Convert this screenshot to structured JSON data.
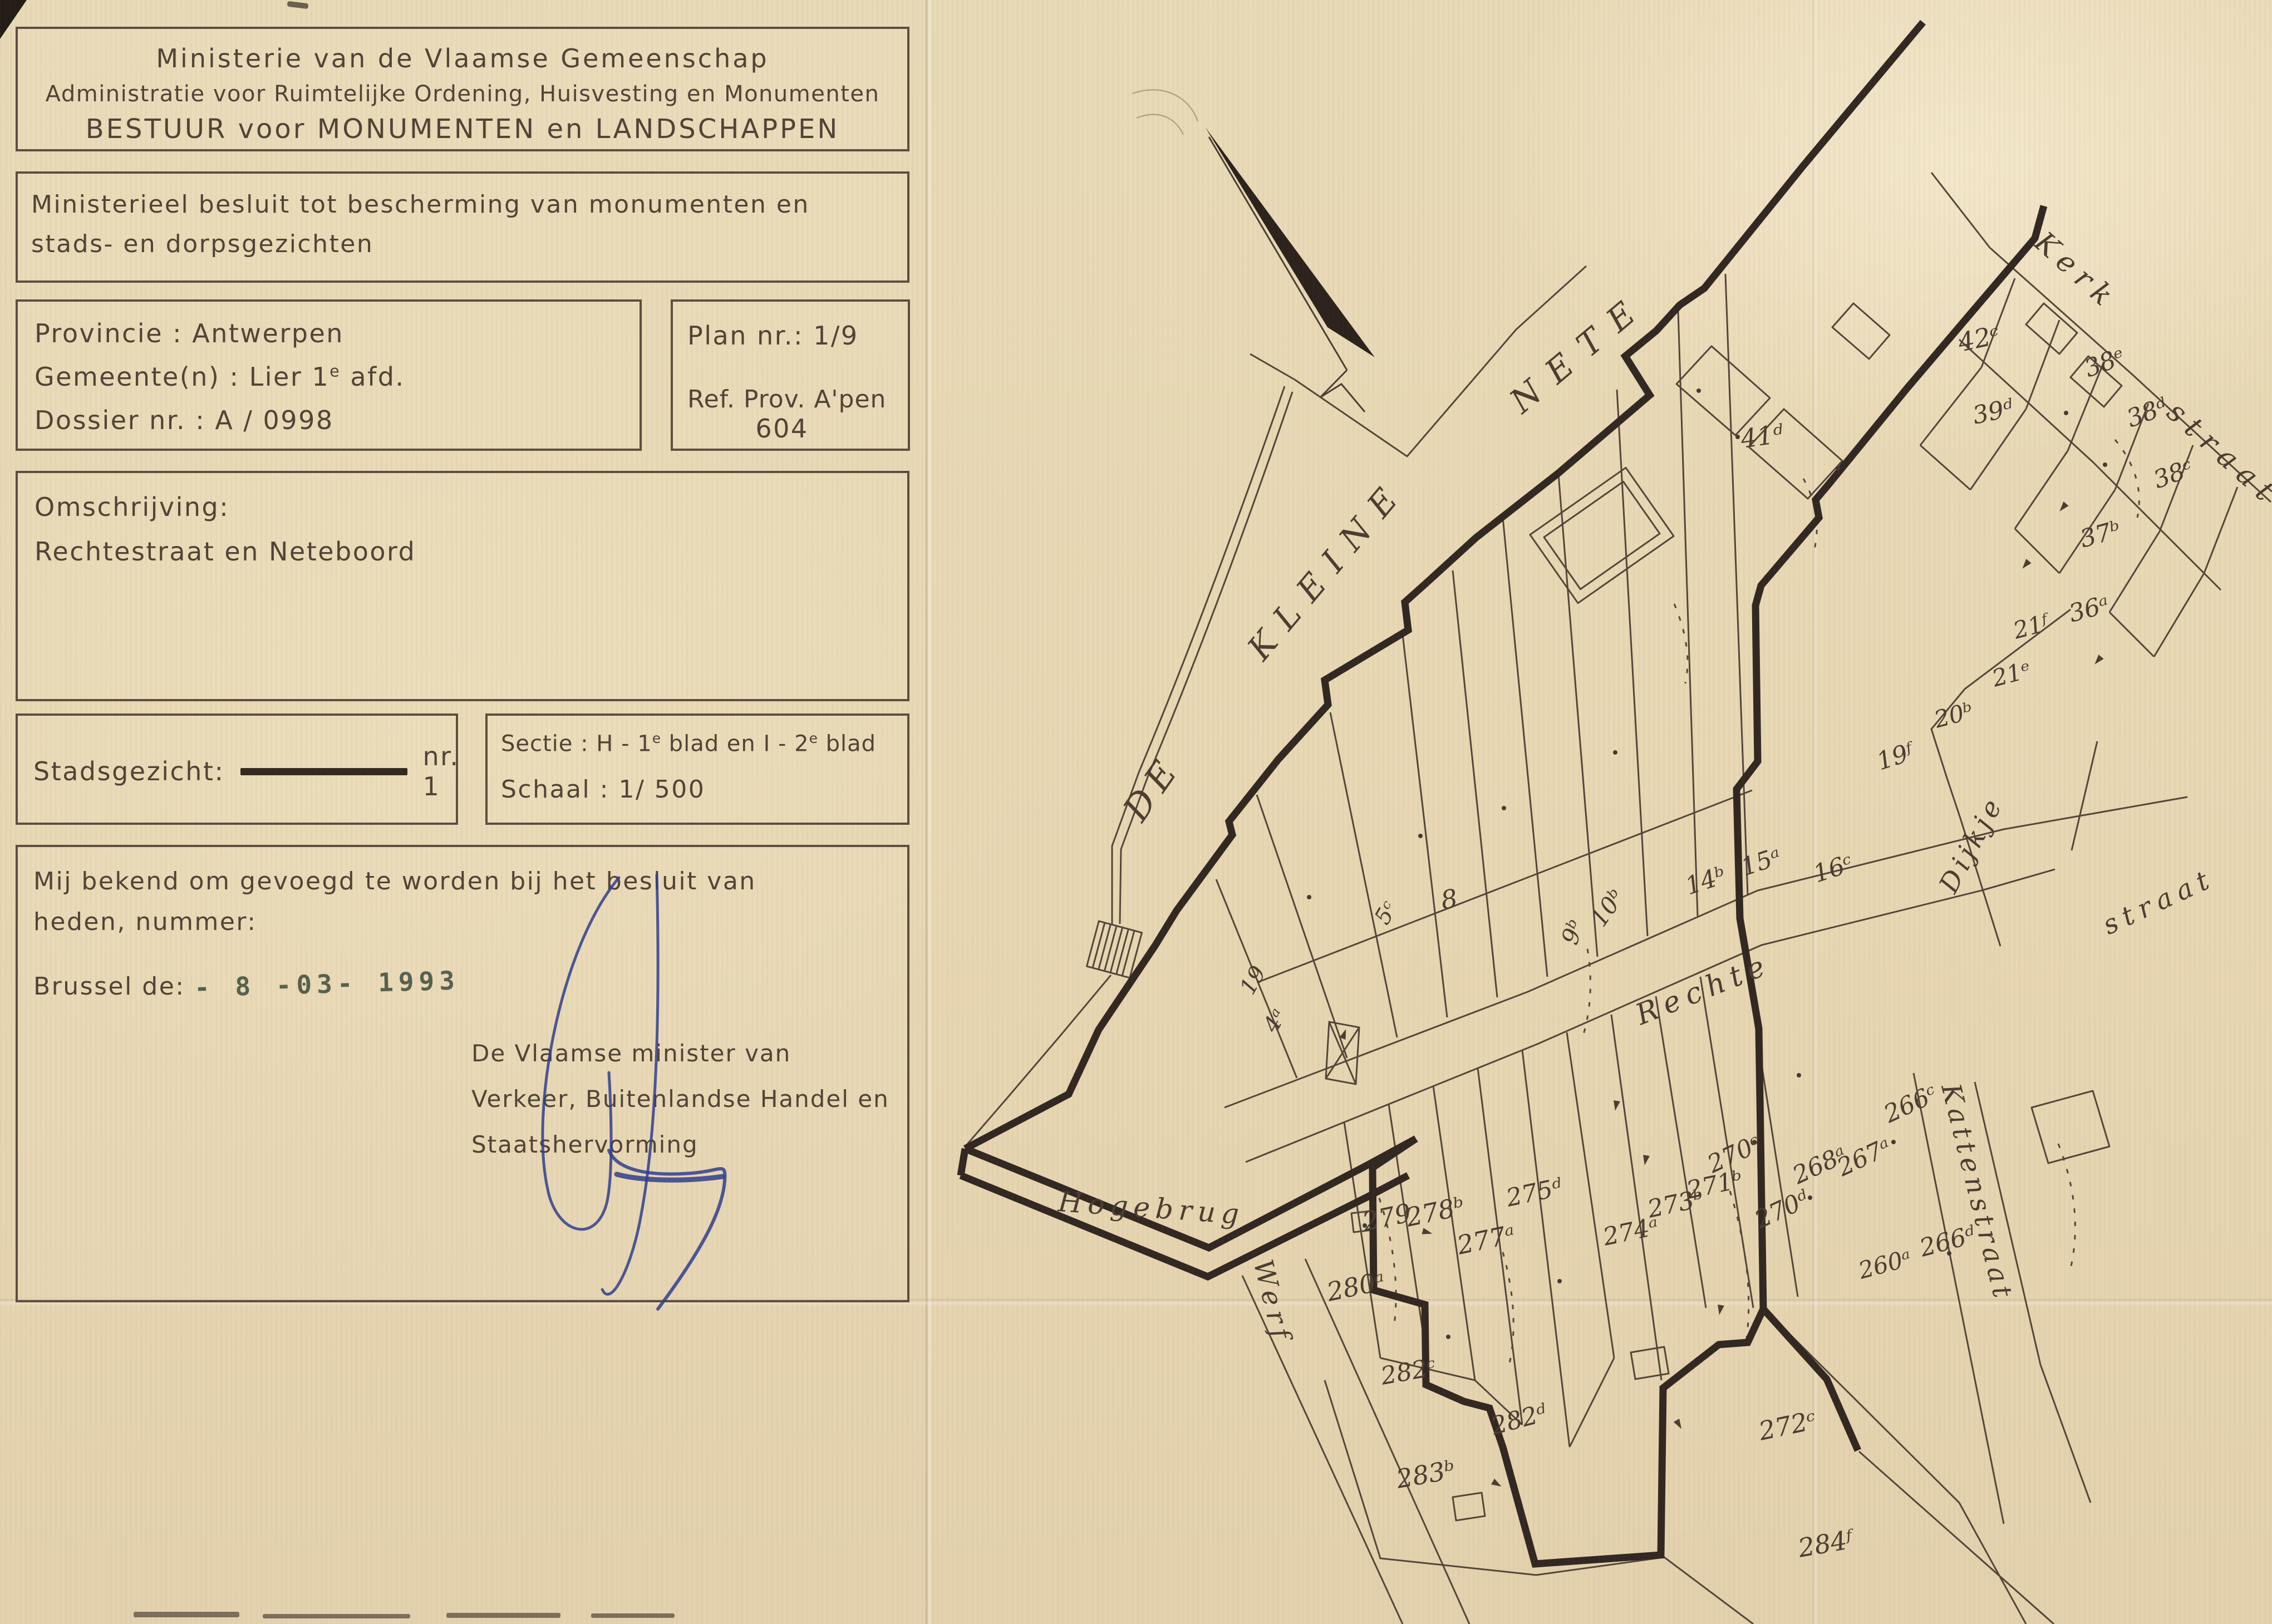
{
  "page": {
    "paper_color": "#e8d8b5",
    "ink_color": "#4b3e33",
    "boundary_color": "#33291f",
    "signature_color": "#2f3e8f",
    "stamp_color": "#57614f"
  },
  "header_box": {
    "line1": "Ministerie van de Vlaamse Gemeenschap",
    "line2": "Administratie voor Ruimtelijke Ordening, Huisvesting en Monumenten",
    "line3": "BESTUUR voor MONUMENTEN en LANDSCHAPPEN"
  },
  "decree_box": {
    "line1": "Ministerieel besluit tot bescherming van monumenten en",
    "line2": "stads- en dorpsgezichten"
  },
  "province_box": {
    "province_line": "Provincie : Antwerpen",
    "gemeente_prefix": "Gemeente(n) : Lier  1",
    "gemeente_sup": "e",
    "gemeente_suffix": " afd.",
    "dossier_line": "Dossier nr. : A / 0998"
  },
  "plan_box": {
    "plan_line": "Plan nr.: 1/9",
    "ref_line": "Ref. Prov. A'pen",
    "ref_number": "604"
  },
  "omschrijving_box": {
    "label": "Omschrijving:",
    "value": "Rechtestraat en Neteboord"
  },
  "stadsgezicht_box": {
    "label": "Stadsgezicht:",
    "value": "nr. 1"
  },
  "sectie_box": {
    "sectie_prefix": "Sectie : H - 1",
    "sup1": "e",
    "sectie_mid": " blad en I - 2",
    "sup2": "e",
    "sectie_suffix": " blad",
    "schaal_line": "Schaal : 1/ 500"
  },
  "bekend_box": {
    "line1": "Mij bekend om gevoegd te worden bij het besluit van",
    "line2": "heden, nummer:",
    "brussel_label": "Brussel de:",
    "date_stamp": "- 8 -03- 1993",
    "minister_line1": "De Vlaamse minister van",
    "minister_line2": "Verkeer, Buitenlandse Handel en",
    "minister_line3": "Staatshervorming"
  },
  "map": {
    "river_label_de": "DE",
    "river_label_kleine": "KLEINE",
    "river_label_nete": "NETE",
    "street_kerk": "Kerk",
    "street_kerk_straat": "straat",
    "street_dijkje": "Dijkje",
    "street_straat": "straat",
    "street_rechte": "Rechte",
    "street_hogebrug": "Hogebrug",
    "street_werf": "Werf",
    "street_kattenstraat": "Kattenstraat",
    "parcels": [
      "41ᵈ",
      "42ᶜ",
      "39ᵈ",
      "38ᵉ",
      "38ᵈ",
      "38ᶜ",
      "37ᵇ",
      "36ᵃ",
      "21ᶠ",
      "21ᵉ",
      "20ᵇ",
      "19ᶠ",
      "16ᶜ",
      "15ᵃ",
      "14ᵇ",
      "10ᵇ",
      "9ᵇ",
      "8",
      "5ᶜ",
      "4ᵃ",
      "19",
      "280ᵃ",
      "279",
      "278ᵇ",
      "277ᵃ",
      "275ᵈ",
      "274ᵃ",
      "273ᵇ",
      "271ᵇ",
      "270ᶜ",
      "270ᵈ",
      "268ᵃ",
      "267ᵃ",
      "266ᶜ",
      "266ᵈ",
      "260ᵃ",
      "282ᶜ",
      "282ᵈ",
      "283ᵇ",
      "272ᶜ",
      "284ᶠ"
    ]
  }
}
